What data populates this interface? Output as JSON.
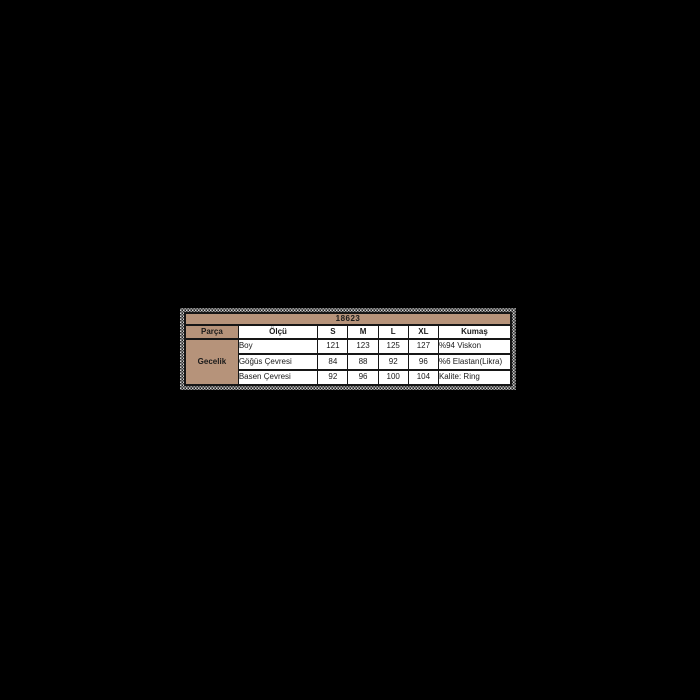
{
  "page": {
    "background": "#000000"
  },
  "colors": {
    "accent_tan": "#b6937a",
    "table_border": "#161616",
    "cell_bg": "#ffffff",
    "text": "#1a1a1a"
  },
  "chart_data": {
    "type": "table",
    "title": "18623",
    "columns": [
      "Parça",
      "Ölçü",
      "S",
      "M",
      "L",
      "XL",
      "Kumaş"
    ],
    "row_group_label": "Gecelik",
    "rows": [
      [
        "Boy",
        "121",
        "123",
        "125",
        "127",
        "%94 Viskon"
      ],
      [
        "Göğüs Çevresi",
        "84",
        "88",
        "92",
        "96",
        "%6 Elastan(Likra)"
      ],
      [
        "Basen Çevresi",
        "92",
        "96",
        "100",
        "104",
        "Kalite: Ring"
      ]
    ]
  }
}
